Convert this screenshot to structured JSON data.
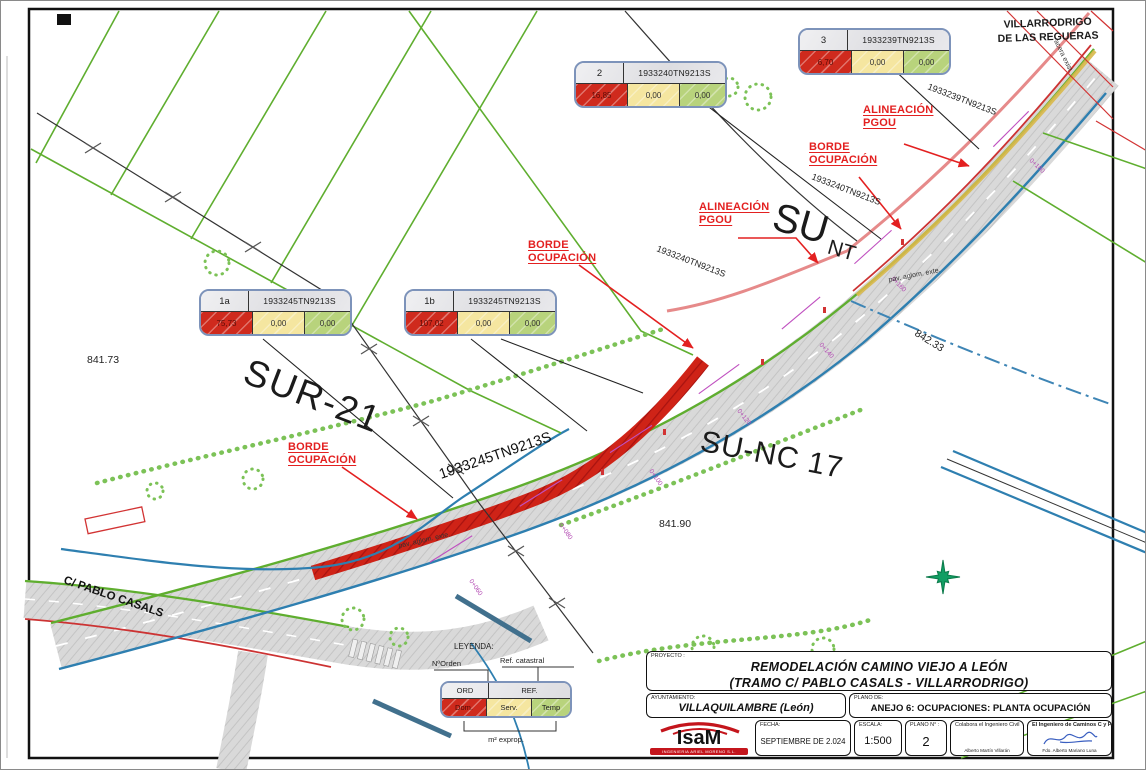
{
  "sheet": {
    "zones": {
      "sur21": "SUR-21",
      "sunc17": "SU-NC 17",
      "su": "SU",
      "nt": "NT",
      "town_line1": "VILLARRODRIGO",
      "town_line2": "DE LAS REGUERAS",
      "street": "C/ PABLO CASALS"
    },
    "annotations": {
      "alineacion_line1": "ALINEACIÓN",
      "alineacion_line2": "PGOU",
      "borde_line1": "BORDE",
      "borde_line2": "OCUPACIÓN"
    },
    "parcel_refs": {
      "ref_239": "1933239TN9213S",
      "ref_240": "1933240TN9213S",
      "ref_245": "1933245TN9213S"
    },
    "elevations": {
      "e1": "841.73",
      "e2": "842.33",
      "e3": "841.90"
    },
    "road_labels": {
      "pav": "pav. aglom. exte.",
      "acera": "acera exist."
    },
    "chainages": [
      "0+060",
      "0+080",
      "0+100",
      "0+120",
      "0+140",
      "0+160",
      "0+180"
    ]
  },
  "tables": [
    {
      "id": "1a",
      "ref": "1933245TN9213S",
      "dom": "75,73",
      "serv": "0,00",
      "temp": "0,00"
    },
    {
      "id": "1b",
      "ref": "1933245TN9213S",
      "dom": "107,02",
      "serv": "0,00",
      "temp": "0,00"
    },
    {
      "id": "2",
      "ref": "1933240TN9213S",
      "dom": "16,85",
      "serv": "0,00",
      "temp": "0,00"
    },
    {
      "id": "3",
      "ref": "1933239TN9213S",
      "dom": "6,70",
      "serv": "0,00",
      "temp": "0,00"
    }
  ],
  "legend": {
    "title": "LEYENDA:",
    "n_orden": "NºOrden",
    "ref_catastral": "Ref. catastral",
    "ord": "ORD",
    "ref": "REF.",
    "dom": "Dom.",
    "serv": "Serv.",
    "temp": "Temp",
    "m2_exprop": "m² exprop."
  },
  "title_block": {
    "proyecto_label": "PROYECTO :",
    "proyecto_line1": "REMODELACIÓN CAMINO VIEJO A LEÓN",
    "proyecto_line2": "(TRAMO C/ PABLO CASALS - VILLARRODRIGO)",
    "ayuntamiento_label": "AYUNTAMIENTO:",
    "ayuntamiento_value": "VILLAQUILAMBRE (León)",
    "plano_de_label": "PLANO DE:",
    "plano_de_value": "ANEJO 6: OCUPACIONES: PLANTA OCUPACIÓN",
    "fecha_label": "FECHA:",
    "fecha_value": "SEPTIEMBRE DE 2.024",
    "escala_label": "ESCALA:",
    "escala_value": "1:500",
    "plano_num_label": "PLANO N° :",
    "plano_num_value": "2",
    "colabora_label": "Colabora el Ingeniero Civil",
    "colabora_name": "Alberto Martín Villarán",
    "ingeniero_label": "El Ingeniero de Caminos C y P.",
    "ingeniero_name": "Fdo. Alberto Mariano Luna",
    "logo_text": "IsaM",
    "logo_tagline": "INGENIERIA ARIEL MORENO S.L."
  },
  "colors": {
    "dom_red": "#cf2a1d",
    "serv_yellow": "#f5e6a0",
    "temp_green": "#b8d37c",
    "annotation_red": "#e32020",
    "parcel_green": "#5fae2f",
    "edge_blue": "#2e7fb0",
    "chainage_magenta": "#c050c0",
    "pgou_pink": "#e68a8a"
  }
}
